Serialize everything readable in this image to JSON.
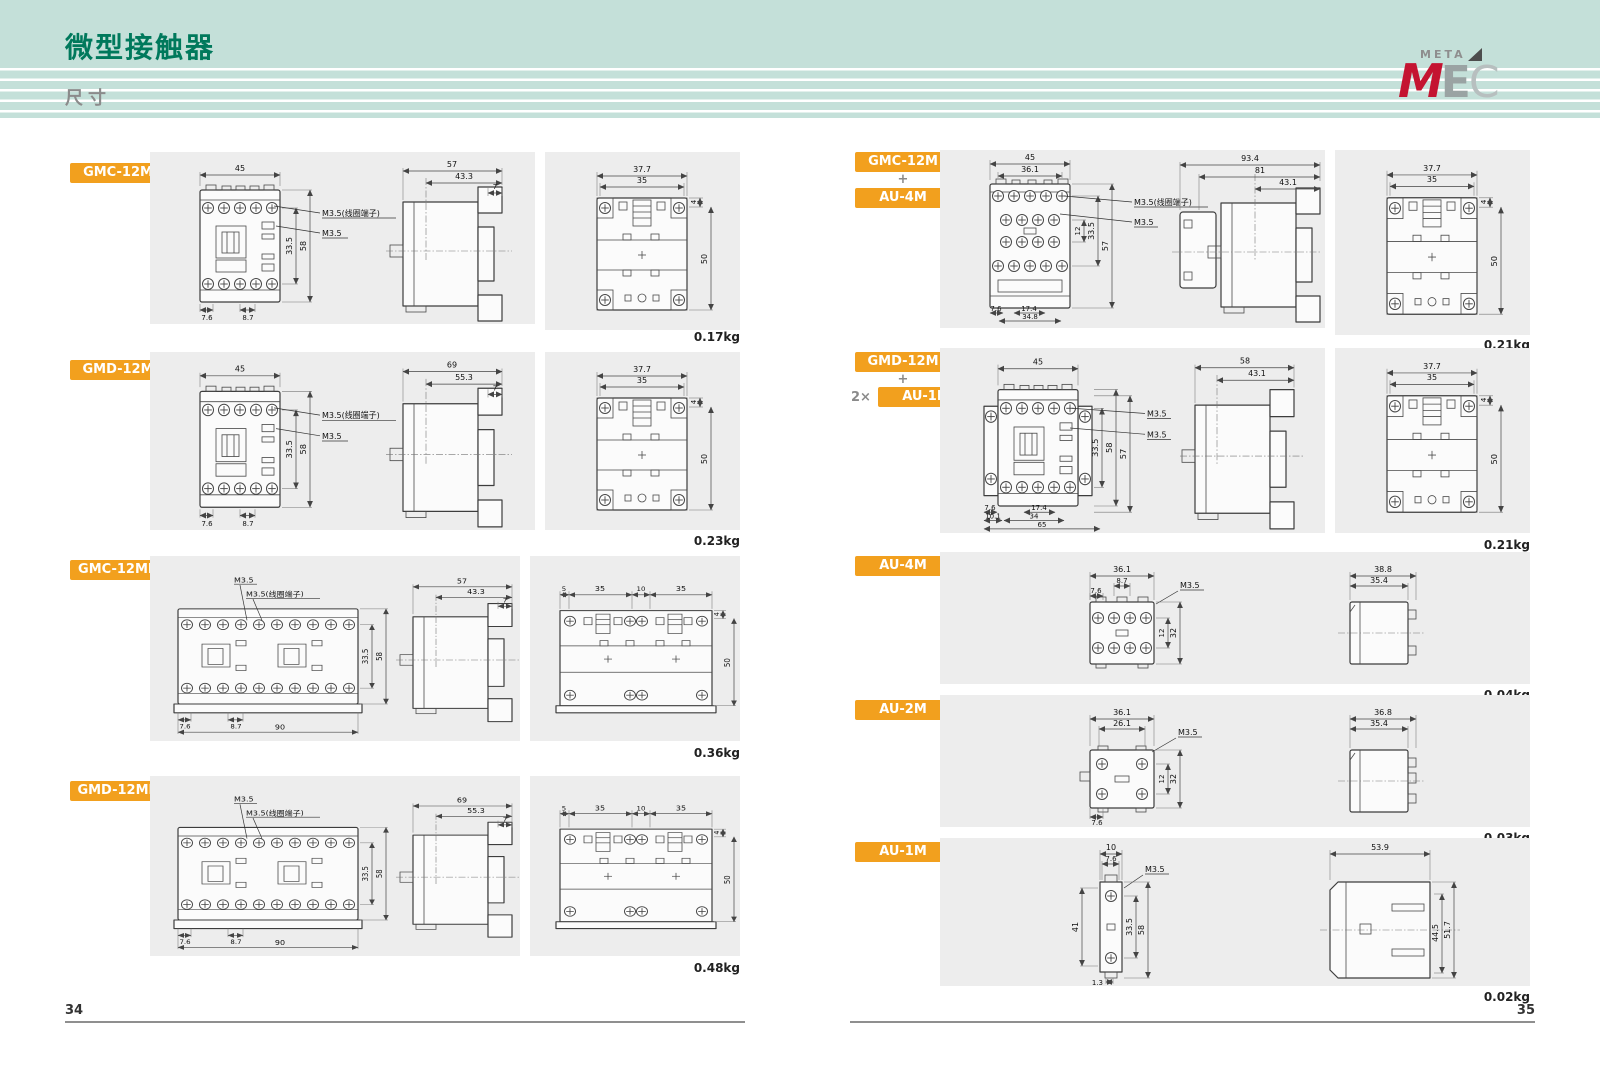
{
  "page": {
    "title": "微型接触器",
    "subtitle": "尺寸",
    "page_left": "34",
    "page_right": "35"
  },
  "logo": {
    "meta": "META",
    "m": "M",
    "e": "E",
    "c": "C"
  },
  "labels": {
    "m35_coil": "M3.5(线圈端子)",
    "m35": "M3.5",
    "plus": "+",
    "times": "2×"
  },
  "colors": {
    "accent_orange": "#f2a01e",
    "header_bg": "#c4e0d9",
    "title_green": "#00795c",
    "logo_red": "#c41431",
    "box_gray": "#ededed"
  },
  "sections": {
    "l1": {
      "badge": "GMC-12M",
      "weight": "0.17kg",
      "front": {
        "w": "45",
        "t": "33.5",
        "h": "58",
        "b1": "7.6",
        "b2": "8.7"
      },
      "side": {
        "d": "57",
        "d2": "43.3",
        "d3": "7"
      },
      "rear": {
        "w": "37.7",
        "w2": "35",
        "t": "4",
        "h": "50"
      }
    },
    "l2": {
      "badge": "GMD-12M",
      "weight": "0.23kg",
      "front": {
        "w": "45",
        "t": "33.5",
        "h": "58",
        "b1": "7.6",
        "b2": "8.7"
      },
      "side": {
        "d": "69",
        "d2": "55.3",
        "d3": "7"
      },
      "rear": {
        "w": "37.7",
        "w2": "35",
        "t": "4",
        "h": "50"
      }
    },
    "l3": {
      "badge": "GMC-12MR",
      "weight": "0.36kg",
      "front": {
        "t": "33.5",
        "h": "58",
        "b1": "7.6",
        "b2": "8.7",
        "w": "90"
      },
      "side": {
        "d": "57",
        "d2": "43.3",
        "d3": "7"
      },
      "rear": {
        "s1": "5",
        "s2": "35",
        "s3": "10",
        "s4": "35",
        "t": "4",
        "h": "50"
      }
    },
    "l4": {
      "badge": "GMD-12MR",
      "weight": "0.48kg",
      "front": {
        "t": "33.5",
        "h": "58",
        "b1": "7.6",
        "b2": "8.7",
        "w": "90"
      },
      "side": {
        "d": "69",
        "d2": "55.3",
        "d3": "7"
      },
      "rear": {
        "s1": "5",
        "s2": "35",
        "s3": "10",
        "s4": "35",
        "t": "4",
        "h": "50"
      }
    },
    "r1": {
      "badge1": "GMC-12M",
      "badge2": "AU-4M",
      "weight": "0.21kg",
      "front": {
        "w": "45",
        "w2": "36.1",
        "p": "12",
        "t": "33.5",
        "h": "57",
        "b1": "7.6",
        "b2": "17.4",
        "b3": "34.8"
      },
      "side": {
        "d": "93.4",
        "d2": "81",
        "d3": "43.1"
      },
      "rear": {
        "w": "37.7",
        "w2": "35",
        "t": "4",
        "h": "50"
      }
    },
    "r2": {
      "badge1": "GMD-12M",
      "badge2": "AU-1M",
      "weight": "0.21kg",
      "front": {
        "w": "45",
        "t": "33.5",
        "h": "58",
        "h2": "57",
        "b1": "7.6",
        "b2": "17.4",
        "b3": "10.1",
        "b4": "34",
        "b5": "65"
      },
      "side": {
        "d": "58",
        "d2": "43.1"
      },
      "rear": {
        "w": "37.7",
        "w2": "35",
        "t": "4",
        "h": "50"
      }
    },
    "r3": {
      "badge": "AU-4M",
      "weight": "0.04kg",
      "front": {
        "w": "36.1",
        "w2": "8.7",
        "l": "7.6",
        "p": "12",
        "h": "32"
      },
      "side": {
        "d": "38.8",
        "d2": "35.4"
      }
    },
    "r4": {
      "badge": "AU-2M",
      "weight": "0.03kg",
      "front": {
        "w": "36.1",
        "w2": "26.1",
        "p": "12",
        "h": "32",
        "b": "7.6"
      },
      "side": {
        "d": "36.8",
        "d2": "35.4"
      }
    },
    "r5": {
      "badge": "AU-1M",
      "weight": "0.02kg",
      "front": {
        "w": "10",
        "w2": "7.6",
        "l": "41",
        "t": "33.5",
        "h": "58",
        "b": "1.3"
      },
      "side": {
        "d": "53.9",
        "h1": "44.5",
        "h2": "51.7"
      }
    }
  }
}
